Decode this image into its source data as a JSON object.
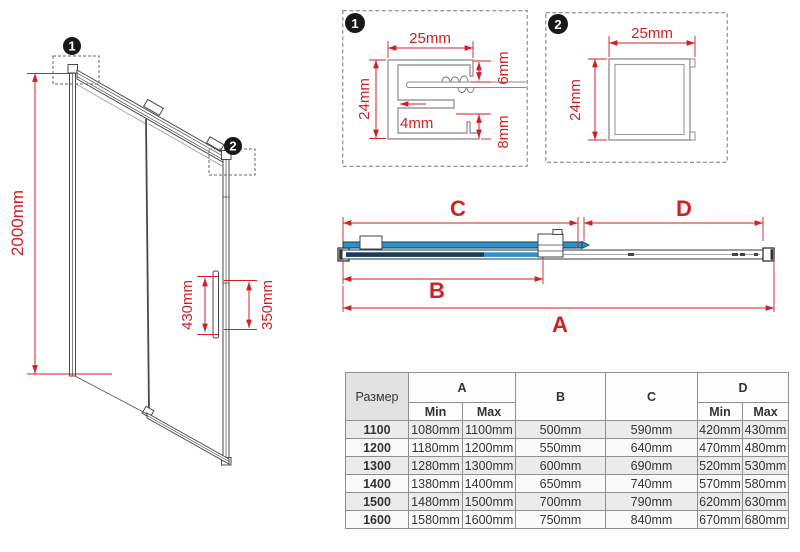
{
  "colors": {
    "dimension_red": "#cf2026",
    "glass_blue": "#2e93c8",
    "glass_navy": "#1c3c56",
    "frame_gray": "#4a4a4a"
  },
  "door_view": {
    "marker1": "1",
    "marker2": "2",
    "height_label": "2000mm",
    "handle_length_label": "430mm",
    "handle_holes_label": "350mm"
  },
  "detail1": {
    "marker": "1",
    "width_label": "25mm",
    "height_label": "24mm",
    "inner_label": "4mm",
    "top_gap_label": "6mm",
    "bottom_gap_label": "8mm"
  },
  "detail2": {
    "marker": "2",
    "width_label": "25mm",
    "height_label": "24mm"
  },
  "plan_view": {
    "total_width_label": "A",
    "door_panel_label": "B",
    "sliding_section_label": "C",
    "fixed_section_label": "D"
  },
  "size_table": {
    "size_header": "Размер",
    "col_a": "A",
    "col_b": "B",
    "col_c": "C",
    "col_d": "D",
    "min_label": "Min",
    "max_label": "Max",
    "rows": [
      {
        "size": "1100",
        "a_min": "1080mm",
        "a_max": "1100mm",
        "b": "500mm",
        "c": "590mm",
        "d_min": "420mm",
        "d_max": "430mm"
      },
      {
        "size": "1200",
        "a_min": "1180mm",
        "a_max": "1200mm",
        "b": "550mm",
        "c": "640mm",
        "d_min": "470mm",
        "d_max": "480mm"
      },
      {
        "size": "1300",
        "a_min": "1280mm",
        "a_max": "1300mm",
        "b": "600mm",
        "c": "690mm",
        "d_min": "520mm",
        "d_max": "530mm"
      },
      {
        "size": "1400",
        "a_min": "1380mm",
        "a_max": "1400mm",
        "b": "650mm",
        "c": "740mm",
        "d_min": "570mm",
        "d_max": "580mm"
      },
      {
        "size": "1500",
        "a_min": "1480mm",
        "a_max": "1500mm",
        "b": "700mm",
        "c": "790mm",
        "d_min": "620mm",
        "d_max": "630mm"
      },
      {
        "size": "1600",
        "a_min": "1580mm",
        "a_max": "1600mm",
        "b": "750mm",
        "c": "840mm",
        "d_min": "670mm",
        "d_max": "680mm"
      }
    ]
  }
}
